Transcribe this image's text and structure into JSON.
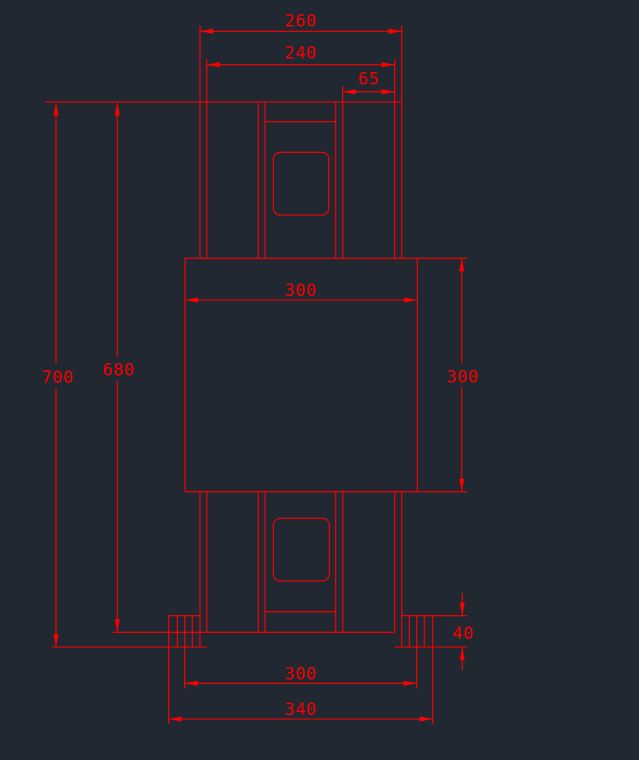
{
  "canvas": {
    "background_color": "#222831",
    "line_color": "#ff0000",
    "view": "front-view technical drawing, red lines on dark CAD model-space background"
  },
  "drawing": {
    "dimension_labels": {
      "top_outer_width": "260",
      "top_inner_width": "240",
      "top_right_offset": "65",
      "overall_height": "700",
      "inner_height": "680",
      "center_block_width": "300",
      "center_block_height": "300",
      "foot_height": "40",
      "base_inner_width": "300",
      "base_outer_width": "340"
    }
  }
}
